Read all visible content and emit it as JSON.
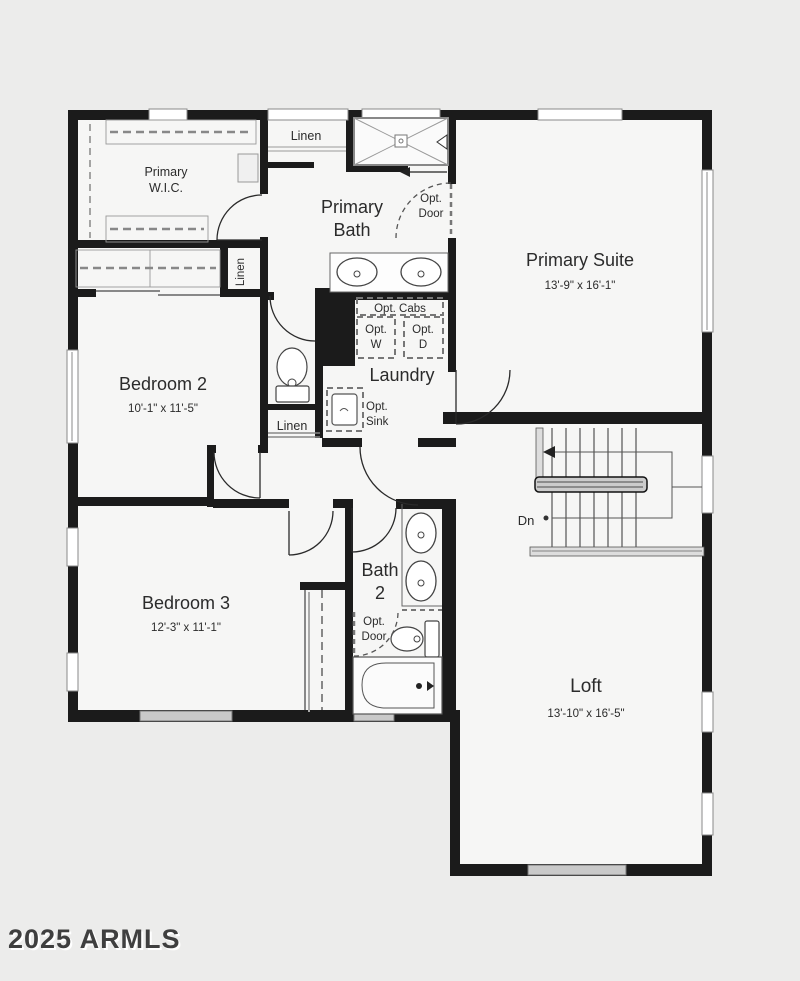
{
  "plan": {
    "rooms": [
      {
        "id": "primary-wic",
        "name": "Primary W.I.C.",
        "name_lines": [
          "Primary",
          "W.I.C."
        ],
        "dims": ""
      },
      {
        "id": "primary-bath",
        "name": "Primary Bath",
        "name_lines": [
          "Primary",
          "Bath"
        ],
        "dims": ""
      },
      {
        "id": "primary-suite",
        "name": "Primary Suite",
        "dims": "13'-9\" x 16'-1\""
      },
      {
        "id": "bedroom-2",
        "name": "Bedroom 2",
        "dims": "10'-1\" x 11'-5\""
      },
      {
        "id": "laundry",
        "name": "Laundry",
        "dims": ""
      },
      {
        "id": "bath-2",
        "name": "Bath 2",
        "name_lines": [
          "Bath",
          "2"
        ],
        "dims": ""
      },
      {
        "id": "bedroom-3",
        "name": "Bedroom 3",
        "dims": "12'-3\" x 11'-1\""
      },
      {
        "id": "loft",
        "name": "Loft",
        "dims": "13'-10\" x 16'-5\""
      }
    ],
    "closets": {
      "linen_upper": "Linen",
      "linen_bedroom2": "Linen",
      "linen_hall": "Linen"
    },
    "options": {
      "cabs": "Opt. Cabs",
      "door_lines": [
        "Opt.",
        "Door"
      ],
      "washer_lines": [
        "Opt.",
        "W"
      ],
      "dryer_lines": [
        "Opt.",
        "D"
      ],
      "sink_lines": [
        "Opt.",
        "Sink"
      ]
    },
    "stairs": {
      "down_label": "Dn"
    },
    "watermark": "2025 ARMLS",
    "colors": {
      "wall": "#1b1b1b",
      "background": "#ececeb",
      "floor": "#f6f6f5",
      "window_gray": "#c9c9c9"
    }
  }
}
